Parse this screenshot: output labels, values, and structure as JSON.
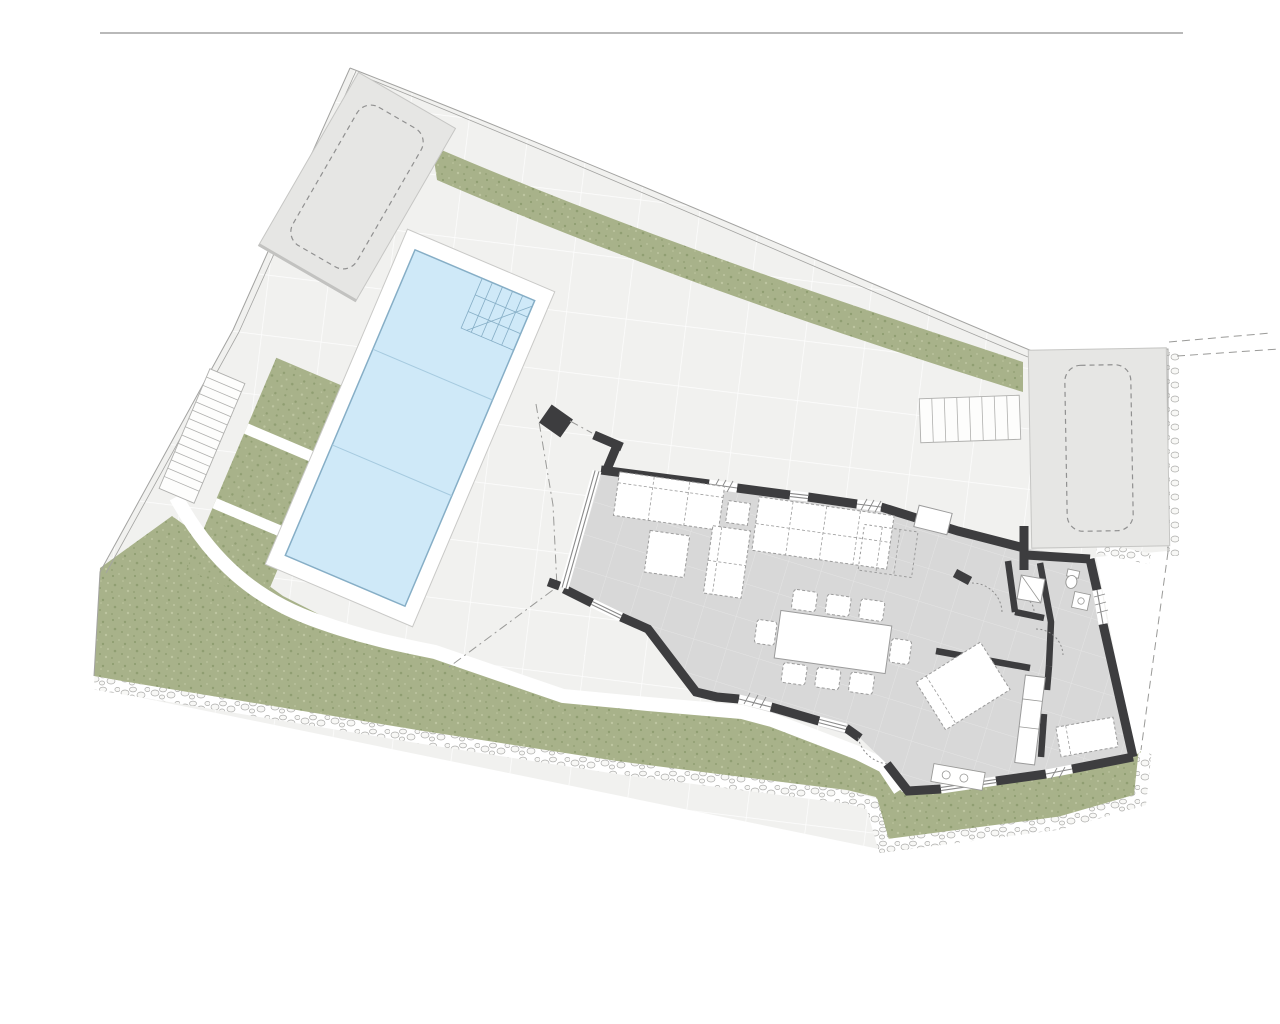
{
  "document": {
    "kind": "architectural-site-plan",
    "view": "top-down ground floor plan of a villa plot with pool and gardens",
    "visible_text": []
  },
  "canvas": {
    "width": 1280,
    "height": 1024
  },
  "colors": {
    "background": "#ffffff",
    "top_rule": "#8f8f8f",
    "boundary_line": "#a3a3a1",
    "dashed_line": "#9a9a98",
    "terrace": "#f1f1ef",
    "terrace_tile_line": "#ffffff",
    "grass": "#a8b28a",
    "grass_dot_dark": "#909e72",
    "grass_dot_light": "#bdc5a0",
    "rubble_stone_edge": "#ababa9",
    "pool_water": "#cfe9f8",
    "pool_edge": "#86aec6",
    "pool_lane": "#a6cadf",
    "deck": "#ffffff",
    "deck_edge": "#c9c9c7",
    "parking": "#e6e6e4",
    "parking_edge": "#c6c6c4",
    "car_outline": "#909090",
    "wall": "#3d3d3f",
    "floor": "#d8d8d8",
    "floor_tile_line": "#e6e6e6",
    "furniture_fill": "#ffffff",
    "furniture_edge": "#9b9b9b",
    "window_line": "#8a8a8a",
    "fixture_edge": "#999997"
  },
  "features": {
    "top_rule": "thin horizontal divider line above the drawing",
    "plot_boundary": "irregular plot boundary with double survey lines",
    "grass_bands": "landscaped green strips along the top and bottom boundaries",
    "rubble_edge": "dry-stone rubble texture along outer plot edges",
    "left_parking": "parking pad upper-left with dashed car outline",
    "right_parking": "parking pad right side with dashed car outline",
    "pool": "rotated rectangular swimming pool with corner steps and two lane joints",
    "pool_deck": "white deck border around pool",
    "garden_stairs": "long exterior stair along the left boundary",
    "planting_beds": "three green planting beds between stairs and pool",
    "walkway": "curved white garden path to the lower lawn",
    "house": "single-storey villa with thick dark walls",
    "living_room": "open plan living-dining room with sofas, coffee tables and dining table for eight",
    "bedroom_wing": "right wing with bathroom, corridor closets and two bedrooms",
    "terrace_stair": "short outdoor stair up to the right parking pad"
  }
}
